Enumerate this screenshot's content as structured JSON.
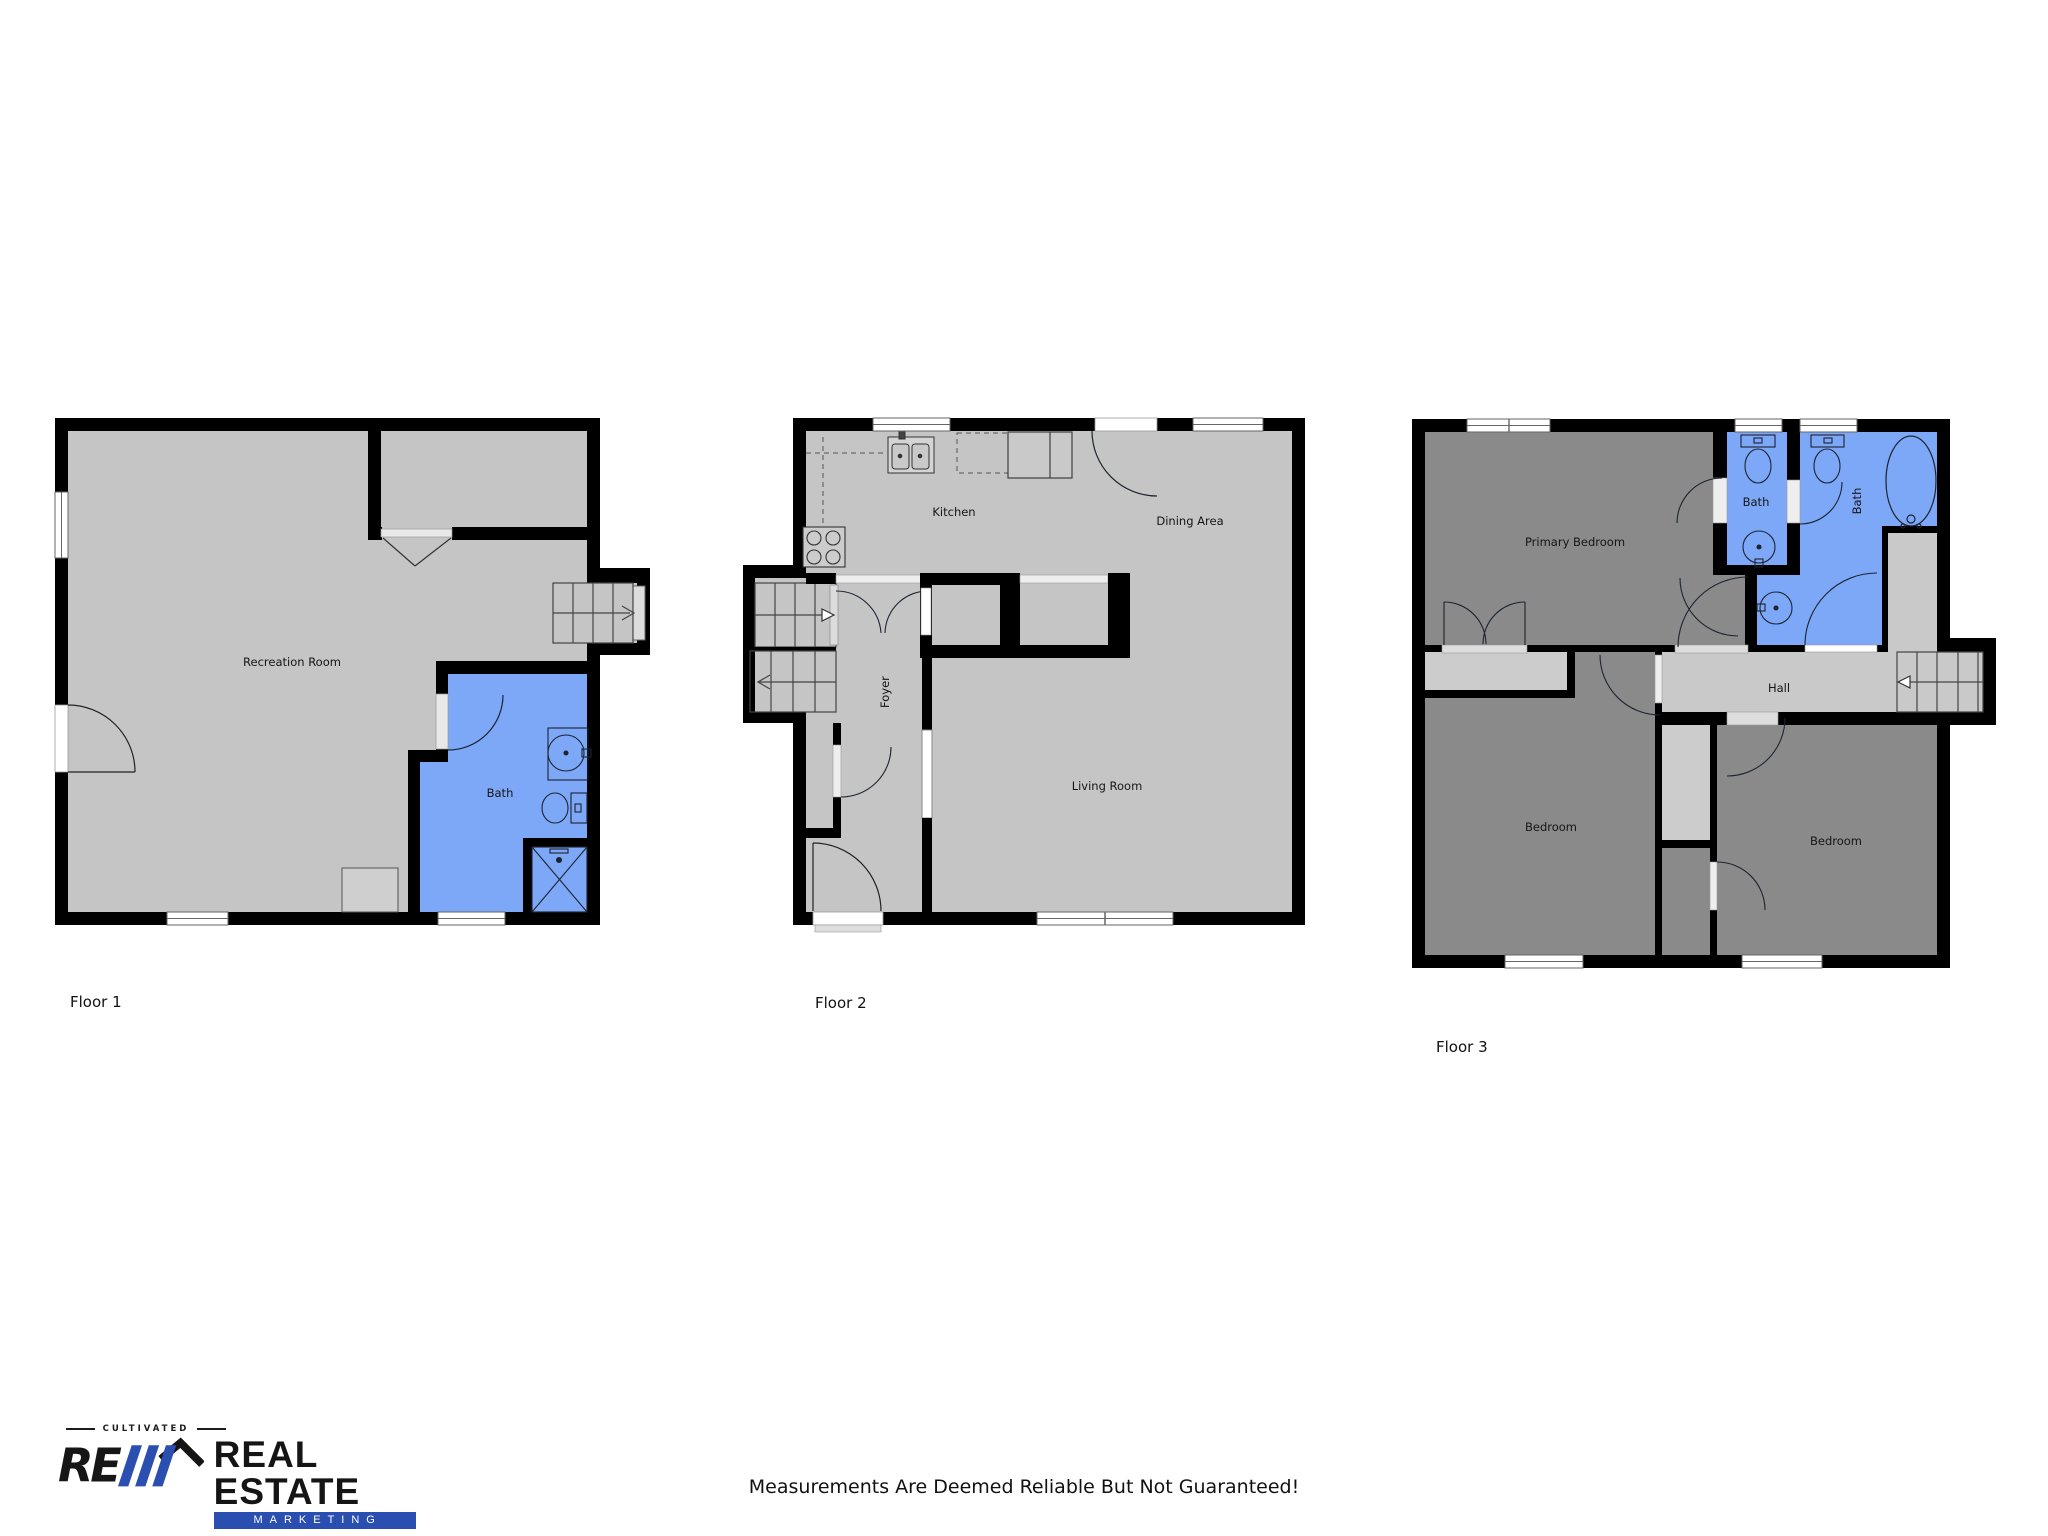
{
  "floors": [
    {
      "label": "Floor 1",
      "rooms": {
        "recreation": "Recreation Room",
        "bath": "Bath"
      }
    },
    {
      "label": "Floor 2",
      "rooms": {
        "kitchen": "Kitchen",
        "dining": "Dining Area",
        "foyer": "Foyer",
        "living": "Living Room"
      }
    },
    {
      "label": "Floor 3",
      "rooms": {
        "primary": "Primary Bedroom",
        "bath1": "Bath",
        "bath2": "Bath",
        "hall": "Hall",
        "bedroom1": "Bedroom",
        "bedroom2": "Bedroom"
      }
    }
  ],
  "logo": {
    "tagline": "CULTIVATED",
    "name_line1": "REAL ESTATE",
    "name_line2": "MARKETING",
    "accent_color": "#2b4fb0"
  },
  "footer": {
    "disclaimer": "Measurements Are Deemed Reliable But Not Guaranteed!"
  },
  "colors": {
    "room_light": "#c5c5c5",
    "room_dark": "#8a8a8a",
    "bath_blue": "#7da7f7",
    "wall": "#000000",
    "threshold": "#dddddd"
  }
}
